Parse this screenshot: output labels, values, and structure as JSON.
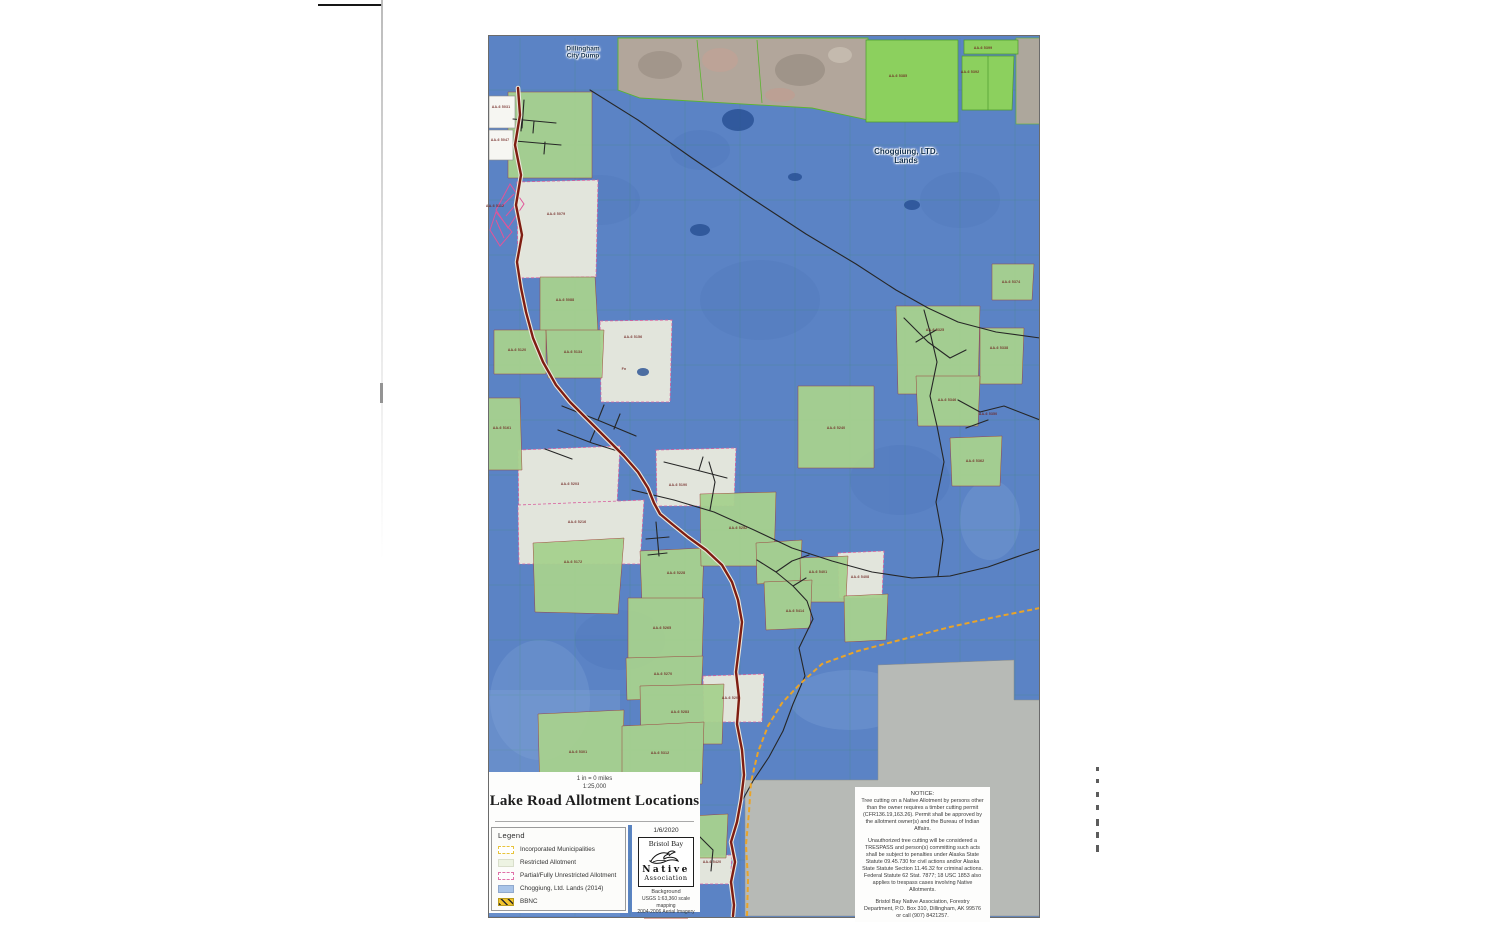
{
  "title_block": {
    "scale_text": "1 in = 0 miles",
    "scale_ratio": "1:25,000",
    "title": "Lake Road Allotment Locations",
    "date": "1/6/2020"
  },
  "logo": {
    "top": "Bristol Bay",
    "mid": "Native",
    "bottom": "Association",
    "credits": [
      "Background",
      "USGS 1:63,360 scale mapping",
      "2004-2006 Aerial Imagery"
    ]
  },
  "legend": {
    "title": "Legend",
    "items": [
      {
        "label": "Incorporated Municipalities",
        "swatch": "municipal"
      },
      {
        "label": "Restricted Allotment",
        "swatch": "restricted"
      },
      {
        "label": "Partial/Fully Unrestricted Allotment",
        "swatch": "unrestricted"
      },
      {
        "label": "Choggiung, Ltd. Lands (2014)",
        "swatch": "choggiung"
      },
      {
        "label": "BBNC",
        "swatch": "bbnc"
      }
    ]
  },
  "notice": {
    "title": "NOTICE:",
    "paragraphs": [
      "Tree cutting on a Native Allotment by persons other than the owner requires a timber cutting permit (CFR136.19,163.26). Permit shall be approved by the allotment owner(s) and the Bureau of Indian Affairs.",
      "Unauthorized tree cutting will be considered a TRESPASS and person(s) committing such acts shall be subject to penalties under Alaska State Statute 09.45.730 for civil actions and/or Alaska State Statute Section 11.46.32 for criminal actions. Federal Statute 62 Stat. 7877; 18 USC 1853 also applies to trespass cases involving Native Allotments.",
      "Bristol Bay Native Association, Forestry Department, P.O. Box 310, Dillingham, AK 99576 or call (907) 8421257."
    ]
  },
  "map_labels": {
    "city_dump_line1": "Dillingham",
    "city_dump_line2": "City Dump",
    "choggiung_line1": "Choggiung, LTD.",
    "choggiung_line2": "Lands"
  },
  "parcel_labels": [
    {
      "t": "AA-6 5031",
      "x": 501,
      "y": 107
    },
    {
      "t": "AA-6 5047",
      "x": 500,
      "y": 140
    },
    {
      "t": "AA-6 5112",
      "x": 495,
      "y": 206
    },
    {
      "t": "AA-6 5079",
      "x": 556,
      "y": 214
    },
    {
      "t": "AA-6 5088",
      "x": 565,
      "y": 300
    },
    {
      "t": "AA-6 5120",
      "x": 517,
      "y": 350
    },
    {
      "t": "AA-6 5134",
      "x": 573,
      "y": 352
    },
    {
      "t": "AA-6 5156",
      "x": 633,
      "y": 337
    },
    {
      "t": "Fn",
      "x": 624,
      "y": 369
    },
    {
      "t": "AA-6 5161",
      "x": 502,
      "y": 428
    },
    {
      "t": "AA-6 5203",
      "x": 570,
      "y": 484
    },
    {
      "t": "AA-6 5216",
      "x": 577,
      "y": 522
    },
    {
      "t": "AA-6 5172",
      "x": 573,
      "y": 562
    },
    {
      "t": "AA-6 5228",
      "x": 676,
      "y": 573
    },
    {
      "t": "AA-6 5190",
      "x": 678,
      "y": 485
    },
    {
      "t": "AA-6 5240",
      "x": 836,
      "y": 428
    },
    {
      "t": "AA-6 5252",
      "x": 738,
      "y": 528
    },
    {
      "t": "AA-6 5265",
      "x": 662,
      "y": 628
    },
    {
      "t": "AA-6 5270",
      "x": 663,
      "y": 674
    },
    {
      "t": "AA-6 5283",
      "x": 680,
      "y": 712
    },
    {
      "t": "AA-6 5290",
      "x": 731,
      "y": 698
    },
    {
      "t": "AA-6 5301",
      "x": 578,
      "y": 752
    },
    {
      "t": "AA-6 5312",
      "x": 660,
      "y": 753
    },
    {
      "t": "AA-6 5325",
      "x": 935,
      "y": 330
    },
    {
      "t": "AA-6 5338",
      "x": 999,
      "y": 348
    },
    {
      "t": "AA-6 5346",
      "x": 947,
      "y": 400
    },
    {
      "t": "AA-6 5350",
      "x": 988,
      "y": 414
    },
    {
      "t": "AA-6 5362",
      "x": 975,
      "y": 461
    },
    {
      "t": "AA-6 5374",
      "x": 1011,
      "y": 282
    },
    {
      "t": "AA-6 5385",
      "x": 898,
      "y": 76
    },
    {
      "t": "AA-6 5392",
      "x": 970,
      "y": 72
    },
    {
      "t": "AA-6 5399",
      "x": 983,
      "y": 48
    },
    {
      "t": "AA-6 5401",
      "x": 818,
      "y": 572
    },
    {
      "t": "AA-6 5408",
      "x": 860,
      "y": 577
    },
    {
      "t": "AA-6 5414",
      "x": 795,
      "y": 611
    },
    {
      "t": "AA-6 5420",
      "x": 712,
      "y": 862
    }
  ],
  "page_marks": {
    "ticks": [
      {
        "y": 767,
        "h": 4
      },
      {
        "y": 779,
        "h": 4
      },
      {
        "y": 792,
        "h": 5
      },
      {
        "y": 805,
        "h": 5
      },
      {
        "y": 819,
        "h": 7
      },
      {
        "y": 832,
        "h": 6
      },
      {
        "y": 845,
        "h": 7
      }
    ]
  },
  "colors": {
    "choggiung_blue": "#5b83c5",
    "restricted_green": "#a7d18f",
    "bright_green": "#8cd05e",
    "unrestricted_light": "#e2e5dc",
    "road_maroon": "#7e1d12",
    "road_yellow": "#eaa428",
    "municipal_yellow": "#e8c43c",
    "water_gray": "#b7bab6"
  }
}
